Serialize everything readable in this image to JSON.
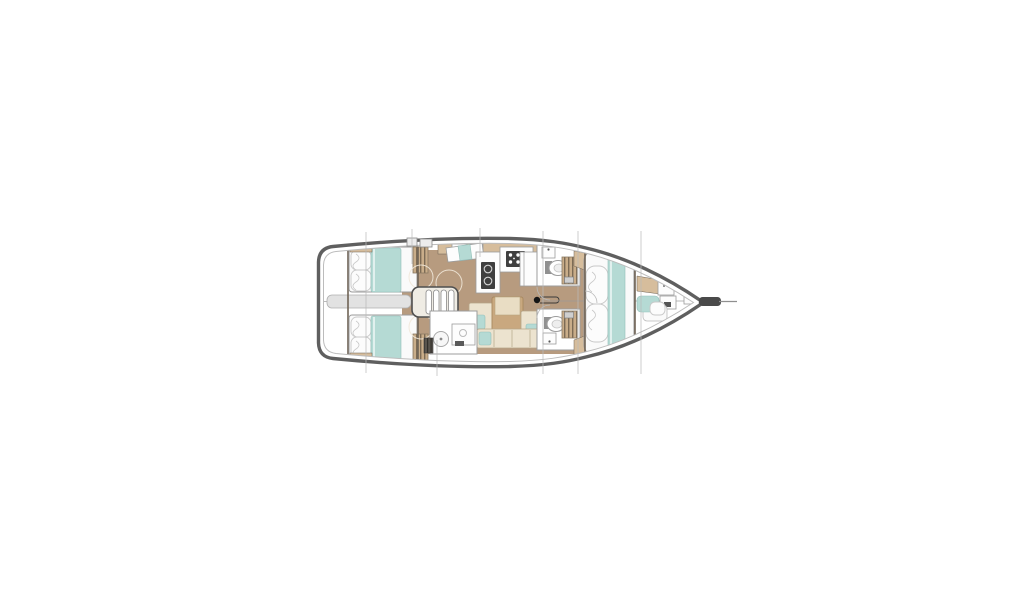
{
  "diagram": {
    "title": "Sailing yacht interior deck plan, top view, bow pointing right",
    "type": "yacht-floor-plan",
    "counts": {
      "cabins": 4,
      "heads": 3,
      "double_berths": 3,
      "single_berths": 1
    },
    "colors": {
      "background": "#ffffff",
      "hull_outline": "#5f5f5f",
      "deck_line": "#bcbcbc",
      "floor_tan": "#b79b7f",
      "furniture_tan": "#d6bd9c",
      "table_tan": "#c9a87f",
      "table_top": "#e9ddc4",
      "sofa_cream": "#ece3cf",
      "sofa_edge": "#b5a588",
      "bedding_teal": "#b5dad4",
      "bedding_edge": "#93bfb9",
      "bed_base": "#fafafa",
      "pillow_edge": "#c8c8c8",
      "room_outline": "#9c9c9c",
      "wall_dark": "#6f6355",
      "appliance_dark": "#3f3f3f",
      "locker_tan": "#c9ad89",
      "locker_stripe": "#7c6b55",
      "steps_fill": "#efece4",
      "steps_outline": "#4f4f4f",
      "engine_gray": "#e2e2e2",
      "rig_line": "#b9b9b9",
      "door_arc": "#f1e8d9",
      "mast_black": "#151515",
      "bowsprit_dark": "#4a4a4a",
      "metal_gray": "#cfcfcf",
      "centerline_gray": "#9a9a9a",
      "fixture_gray": "#909090"
    },
    "features": {
      "stern": [
        "transom-platform",
        "engine-compartment",
        "centerline"
      ],
      "aft_cabins": [
        "double-berth-port",
        "double-berth-starboard",
        "hanging-lockers"
      ],
      "companionway": [
        "steps"
      ],
      "galley": [
        "nav-seat",
        "double-sink-unit",
        "stove-with-burners",
        "refrigerator",
        "overhead-lockers"
      ],
      "saloon": [
        "table",
        "sofa-bench",
        "side-seats",
        "teal-cushions"
      ],
      "heads": [
        "aft-head-shower",
        "aft-head-basin",
        "port-head-toilet",
        "port-head-basin",
        "starboard-head-toilet",
        "starboard-head-basin"
      ],
      "forward_cabin": [
        "double-berth",
        "side-shelves",
        "pillows",
        "teal-runner"
      ],
      "bow_cabin": [
        "single-berth",
        "basin",
        "locker-shelf"
      ],
      "rig": [
        "mast-step",
        "bowsprit-anchor-roller",
        "section-lines"
      ]
    }
  }
}
